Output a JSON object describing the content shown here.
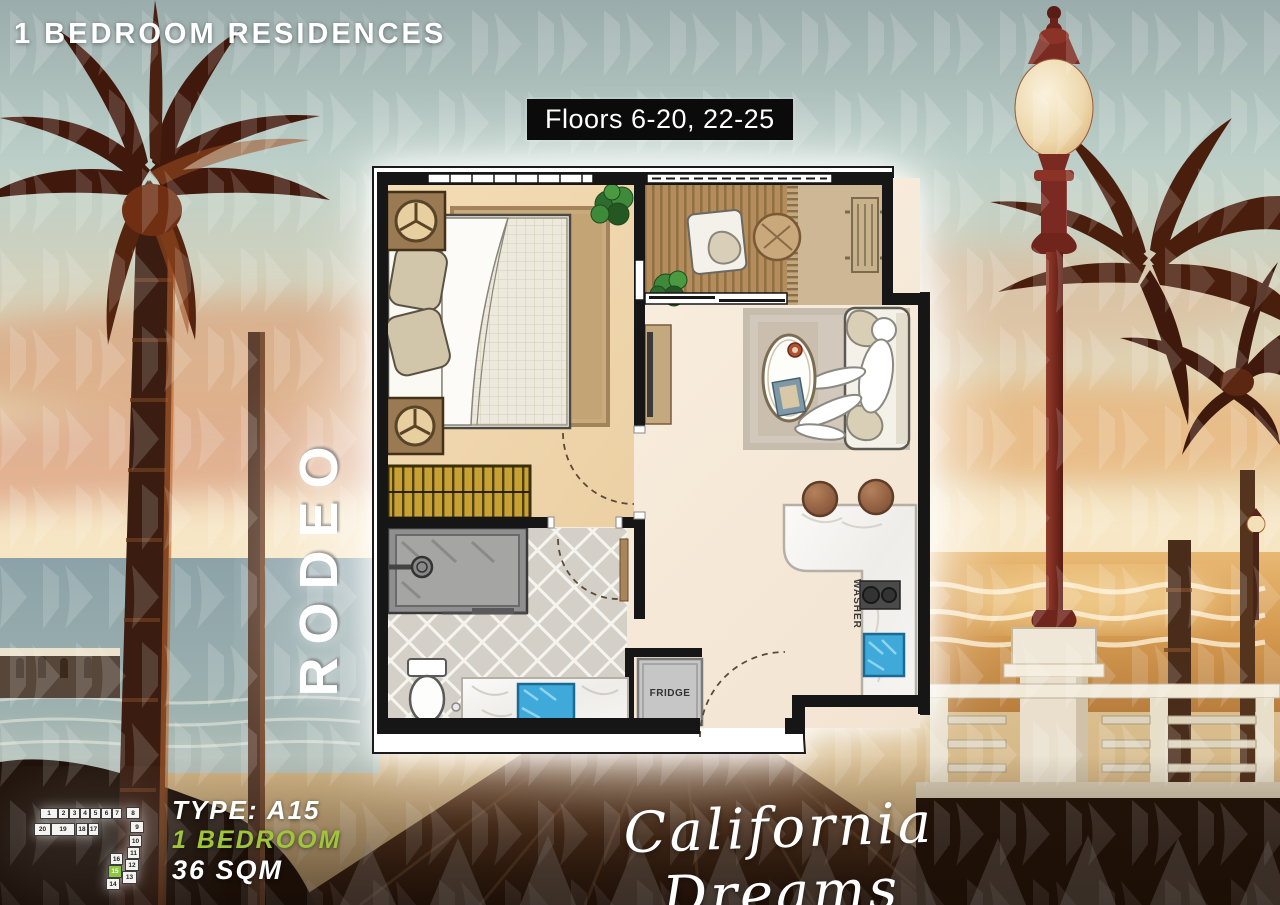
{
  "header": {
    "title": "1 BEDROOM RESIDENCES"
  },
  "floors_badge": {
    "label": "Floors 6-20, 22-25",
    "bg_color": "#0b0b0b",
    "text_color": "#ffffff"
  },
  "tower": {
    "name": "RODEO"
  },
  "floor_plan": {
    "fridge_label": "FRIDGE",
    "washer_label": "WASHER"
  },
  "unit_info": {
    "type_label": "TYPE: A15",
    "bedrooms_label": "1 BEDROOM",
    "area_label": "36 SQM",
    "accent_color": "#9fc63b"
  },
  "tagline": {
    "text": "California Dreams"
  },
  "key_plan": {
    "highlighted_unit": "15",
    "highlight_color": "#8dc63f",
    "units": [
      {
        "label": "1",
        "x": 10,
        "y": 6,
        "w": 18,
        "h": 11
      },
      {
        "label": "2",
        "x": 28,
        "y": 6,
        "w": 11,
        "h": 11
      },
      {
        "label": "3",
        "x": 39,
        "y": 6,
        "w": 11,
        "h": 11
      },
      {
        "label": "4",
        "x": 50,
        "y": 6,
        "w": 10,
        "h": 11
      },
      {
        "label": "5",
        "x": 60,
        "y": 6,
        "w": 11,
        "h": 11
      },
      {
        "label": "6",
        "x": 71,
        "y": 6,
        "w": 11,
        "h": 11
      },
      {
        "label": "7",
        "x": 82,
        "y": 6,
        "w": 10,
        "h": 11
      },
      {
        "label": "8",
        "x": 96,
        "y": 5,
        "w": 14,
        "h": 12
      },
      {
        "label": "9",
        "x": 100,
        "y": 19,
        "w": 14,
        "h": 12
      },
      {
        "label": "10",
        "x": 99,
        "y": 33,
        "w": 13,
        "h": 12
      },
      {
        "label": "11",
        "x": 97,
        "y": 45,
        "w": 13,
        "h": 12
      },
      {
        "label": "12",
        "x": 95,
        "y": 57,
        "w": 14,
        "h": 12
      },
      {
        "label": "13",
        "x": 92,
        "y": 69,
        "w": 15,
        "h": 13
      },
      {
        "label": "14",
        "x": 76,
        "y": 76,
        "w": 14,
        "h": 12
      },
      {
        "label": "15",
        "x": 78,
        "y": 63,
        "w": 14,
        "h": 13
      },
      {
        "label": "16",
        "x": 80,
        "y": 51,
        "w": 13,
        "h": 12
      },
      {
        "label": "17",
        "x": 58,
        "y": 21,
        "w": 11,
        "h": 13
      },
      {
        "label": "18",
        "x": 46,
        "y": 21,
        "w": 12,
        "h": 13
      },
      {
        "label": "19",
        "x": 21,
        "y": 21,
        "w": 24,
        "h": 13
      },
      {
        "label": "20",
        "x": 4,
        "y": 21,
        "w": 17,
        "h": 13
      }
    ]
  }
}
